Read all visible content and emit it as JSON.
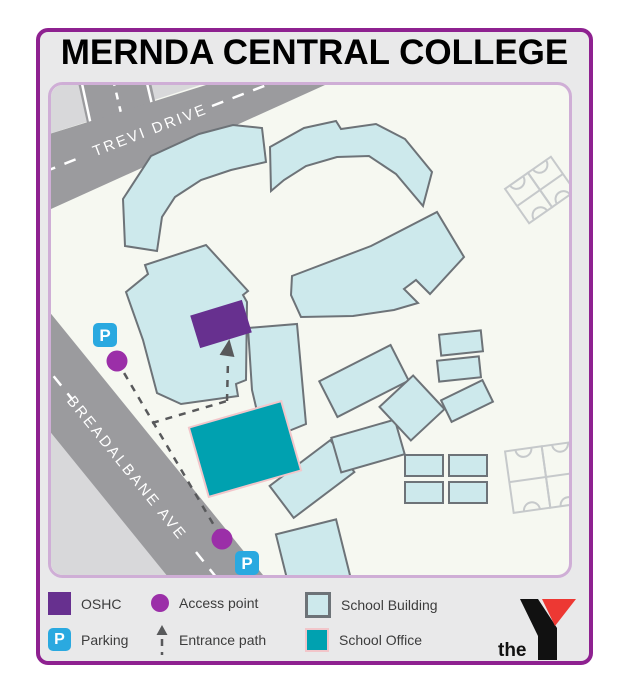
{
  "title": "MERNDA CENTRAL COLLEGE",
  "map": {
    "roads": {
      "trevi": "TREVI DRIVE",
      "breadalbane": "BREADALBANE AVE"
    },
    "parking_letter": "P"
  },
  "legend": {
    "oshc": "OSHC",
    "parking": "Parking",
    "access_point": "Access point",
    "entrance_path": "Entrance path",
    "school_building": "School Building",
    "school_office": "School Office"
  },
  "logo": {
    "word": "the"
  },
  "colors": {
    "card_border_purple": "#8e2190",
    "card_background": "#e9e9ea",
    "panel_border": "#cfaed6",
    "campus_background": "#f6f8f1",
    "road_gray": "#9b9b9e",
    "far_land_gray": "#d8d8da",
    "building_fill": "#cde9ec",
    "building_stroke": "#6d7378",
    "oshc_purple": "#67308f",
    "school_office_teal": "#00a1b0",
    "school_office_border": "#f2c6ca",
    "access_point_purple": "#9b2fa8",
    "parking_blue": "#2aa9e0",
    "entrance_path_gray": "#58595b",
    "logo_red": "#ed3833"
  }
}
